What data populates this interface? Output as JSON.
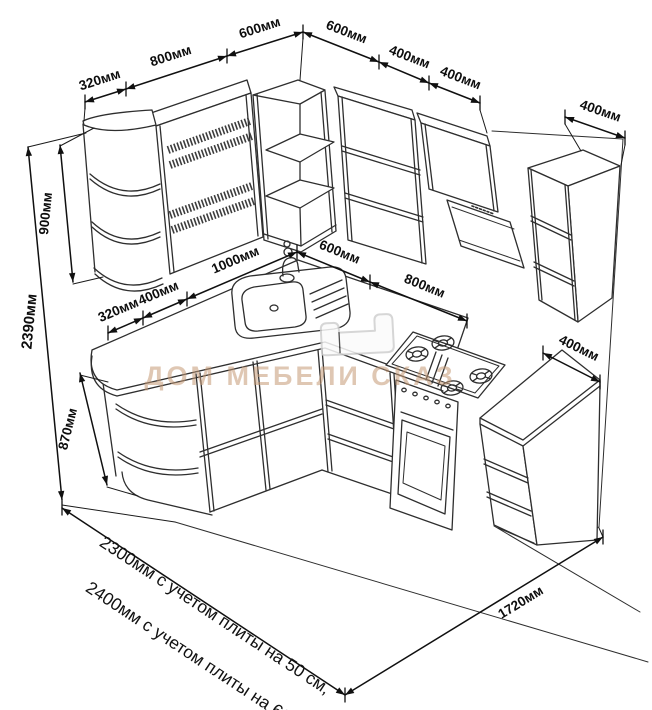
{
  "colors": {
    "line": "#2e2e2e",
    "dim": "#101010",
    "watermark": "#c59a76"
  },
  "dimensions": {
    "top_left_chain": {
      "d320": "320мм",
      "d800": "800мм",
      "d600": "600мм"
    },
    "top_right_chain": {
      "d600": "600мм",
      "d400a": "400мм",
      "d400b": "400мм"
    },
    "right_wall_cabinet_depth": "400мм",
    "total_height": "2390мм",
    "wall_cabinet_height": "900мм",
    "base_cabinet_height": "870мм",
    "counter_left_chain": {
      "d320": "320мм",
      "d400": "400мм",
      "d1000": "1000мм"
    },
    "counter_right_chain": {
      "d600": "600мм",
      "d800": "800мм"
    },
    "side_counter_depth": "400мм",
    "floor_right_length": "1720мм"
  },
  "notes": {
    "length_note_1": "2300мм с учетом плиты на 50 см,",
    "length_note_2": "2400мм с учетом плиты на 60 см"
  },
  "watermark": {
    "brand": "ДОМ МЕБЕЛИ СКАЗ"
  }
}
